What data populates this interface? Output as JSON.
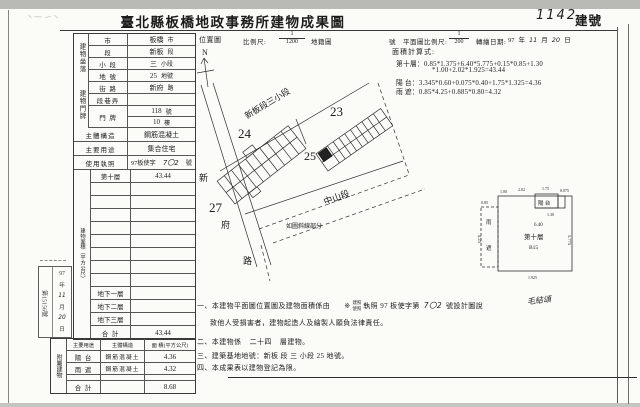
{
  "header": {
    "title": "臺北縣板橋地政事務所建物成果圖",
    "building_no": "1142",
    "building_no_label": "建號",
    "scribble": "丶一 ㇀丶"
  },
  "map_header": {
    "location_label": "位置圖",
    "scale_label": "比例尺:",
    "scale_num": "1",
    "scale_den": "1200",
    "cadastral_label": "地籍圖",
    "no_label": "號",
    "plan_scale_label": "平面圖比例尺:",
    "plan_scale_num": "1",
    "plan_scale_den": "200",
    "redraw_label": "轉繪日期:",
    "year": "97",
    "year_unit": "年",
    "month": "11",
    "month_unit": "月",
    "day": "20",
    "day_unit": "日",
    "north": "N"
  },
  "location_table": {
    "group_label": "建物坐落",
    "rows": [
      {
        "label": "市",
        "value": "板橋",
        "suffix": "市"
      },
      {
        "label": "段",
        "value": "新板",
        "suffix": "段"
      },
      {
        "label": "小 段",
        "value": "三",
        "suffix": "小段"
      },
      {
        "label": "地 號",
        "value": "25",
        "suffix": "地號"
      }
    ]
  },
  "door_table": {
    "group_label": "建物門牌",
    "street_label": "街 路",
    "street_value": "新府",
    "street_suffix": "路",
    "lane_label": "段巷弄",
    "door_label": "門 牌",
    "door_no": "118",
    "door_no_suffix": "號",
    "door_floor": "10",
    "door_floor_suffix": "樓"
  },
  "attr_rows": {
    "structure_label": "主體構造",
    "structure_value": "鋼筋混凝土",
    "usage_label": "主要用途",
    "usage_value": "集合住宅",
    "license_label": "使用執照",
    "license_prefix": "97板使字",
    "license_no": "7〇2",
    "license_suffix": "號"
  },
  "area_table": {
    "group_label": "建物面積（平方公尺）",
    "floor10_label": "第十層",
    "floor10_value": "43.44",
    "b1_label": "地下一層",
    "b2_label": "地下二層",
    "b3_label": "地下三層",
    "total_label": "合 計",
    "total_value": "43.44"
  },
  "annex_table": {
    "group_label": "附屬建物",
    "col_use": "主要用途",
    "col_structure": "主體構造",
    "col_area": "面 積(平方公尺)",
    "rows": [
      {
        "use": "陽 台",
        "structure": "鋼筋混凝土",
        "area": "4.36"
      },
      {
        "use": "雨 遮",
        "structure": "鋼筋混凝土",
        "area": "4.32"
      }
    ],
    "total_label": "合 計",
    "total_area": "8.68"
  },
  "stamp": {
    "number": "第15156號",
    "year": "97",
    "year_unit": "年",
    "month": "11",
    "month_unit": "月",
    "day": "20",
    "day_unit": "日"
  },
  "map": {
    "section_label": "新板段三小段",
    "parcel_23": "23",
    "parcel_24": "24",
    "parcel_25": "25",
    "parcel_27": "27",
    "road_left_char1": "新",
    "road_left_char2": "府",
    "road_left_char3": "路",
    "road_bottom": "中山段",
    "note": "如圖斜線部分"
  },
  "calc": {
    "title": "面積計算式:",
    "line1_label": "第十層：",
    "line1_expr": "0.85*1.375+6.40*5.775+0.15*0.85+1.30",
    "line2_expr": "*1.00+2.02*1.925=43.44",
    "line3_label": "陽 台：",
    "line3_expr": "3.345*0.60+0.075*0.40+1.75*1.325=4.36",
    "line4_label": "雨 遮：",
    "line4_expr": "0.85*4.25+0.885*0.80=4.32"
  },
  "floorplan": {
    "floor_label": "第十層",
    "unit_label": "B15",
    "balcony_label": "陽 台",
    "canopy_char1": "雨",
    "canopy_char2": "遮",
    "dim_top1": "1.00",
    "dim_top2": "2.02",
    "dim_top3": "1.75",
    "dim_top4": "0.075",
    "dim_inner": "6.40",
    "dim_right": "5.775",
    "dim_left": "4.25",
    "dim_left2": "0.85",
    "dim_mid": "1.30",
    "dim_bottom": "1.925"
  },
  "notes": {
    "n1_pre": "一、本建物平面圖位置圖及建物面積係由",
    "n1_mark": "※",
    "n1_opt_top": "建照",
    "n1_opt_bottom": "使照",
    "n1_mid": "執照 97 板使字第",
    "n1_no": "7〇2",
    "n1_post": "號設計圖說",
    "n1_sign": "毛結頌",
    "n1_line2": "致他人受損害者，建物起造人及繪製人願負法律責任。",
    "n2_pre": "二、本建物係",
    "n2_val": "二十四",
    "n2_post": "層建物。",
    "n3": "三、建築基地地號：新板 段 三 小段 25 地號。",
    "n4": "四、本成果表以建物登記為限。"
  }
}
